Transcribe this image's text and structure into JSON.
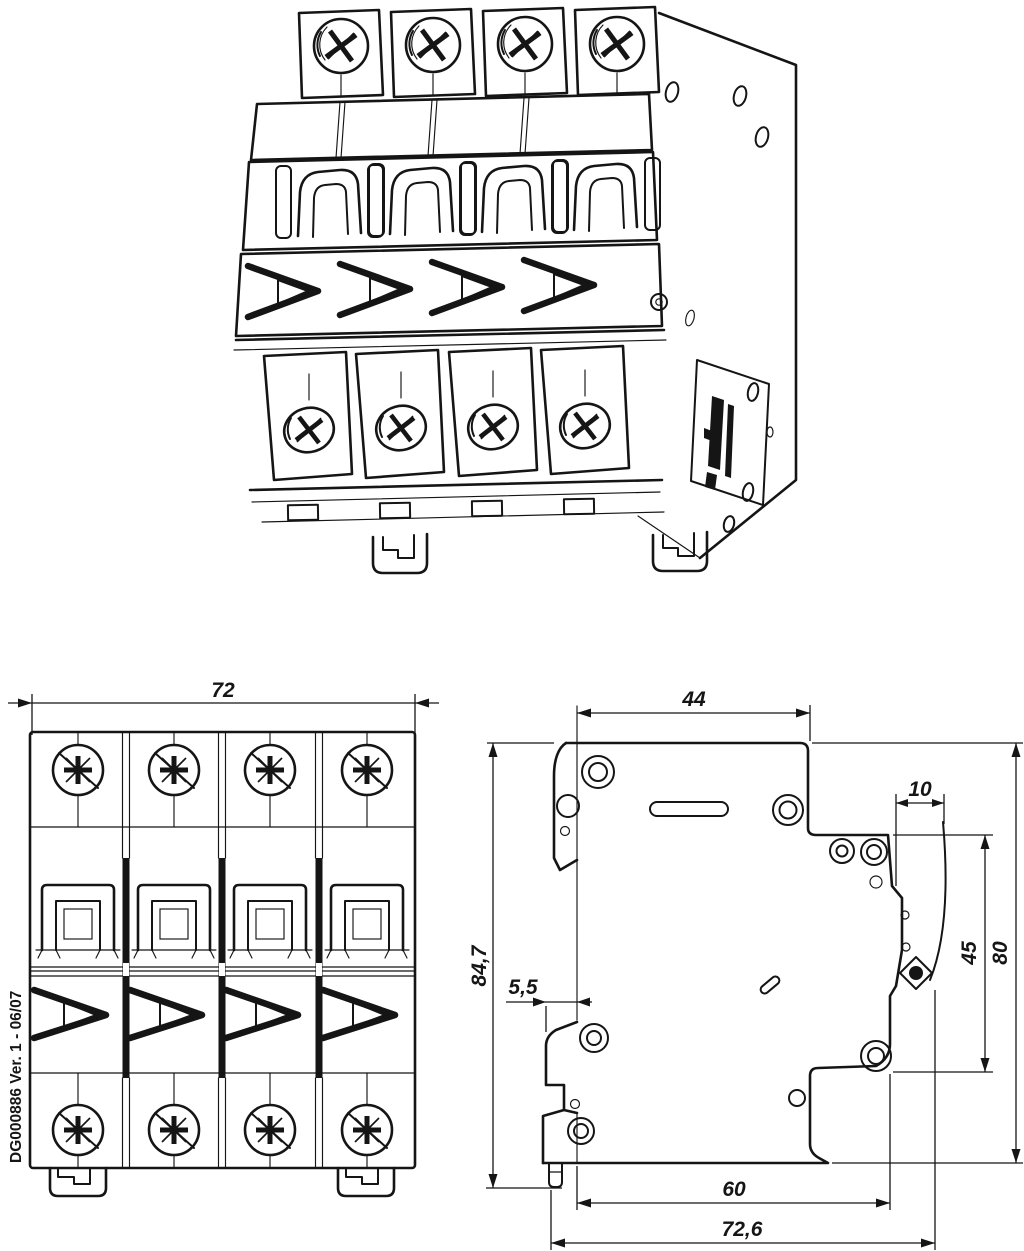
{
  "drawing": {
    "ink_color": "#151515",
    "background": "#ffffff"
  },
  "front_view": {
    "dim_width": "72",
    "marking": "DG000886 Ver. 1 - 06/07"
  },
  "side_view": {
    "dim_top_depth": "44",
    "dim_terminal_depth": "10",
    "dim_overall_height": "84,7",
    "dim_din_clip_offset": "5,5",
    "dim_step_height": "45",
    "dim_body_height": "80",
    "dim_base_depth": "60",
    "dim_overall_depth": "72,6"
  }
}
